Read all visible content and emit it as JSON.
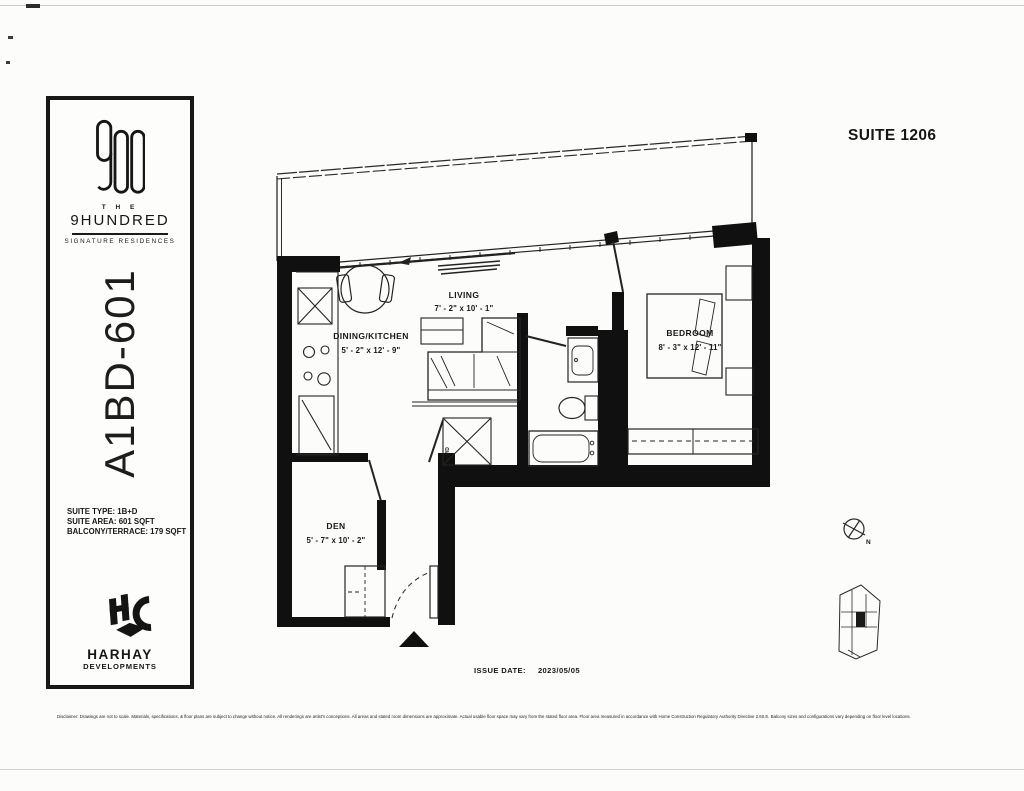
{
  "page": {
    "suite_title": "SUITE 1206",
    "colors": {
      "ink": "#161616",
      "paper": "#fcfcfa"
    }
  },
  "sidebar": {
    "brand": {
      "logo": "900-logo",
      "the": "T H E",
      "name": "9HUNDRED",
      "tagline": "SIGNATURE RESIDENCES"
    },
    "model_code": "A1BD-601",
    "details": [
      "SUITE TYPE: 1B+D",
      "SUITE AREA: 601 SQFT",
      "BALCONY/TERRACE: 179 SQFT"
    ],
    "developer": {
      "logo": "HC",
      "name": "HARHAY",
      "subtitle": "DEVELOPMENTS"
    }
  },
  "floorplan": {
    "rooms": [
      {
        "name": "LIVING",
        "dimensions": "7' - 2\" x 10' - 1\""
      },
      {
        "name": "DINING/KITCHEN",
        "dimensions": "5' - 2\" x 12' - 9\""
      },
      {
        "name": "BEDROOM",
        "dimensions": "8' - 3\" x 12' - 11\""
      },
      {
        "name": "DEN",
        "dimensions": "5' - 7\" x 10' - 2\""
      }
    ],
    "labels": {
      "wd": "W/D",
      "north": "N"
    }
  },
  "footer": {
    "issue_date_label": "ISSUE DATE:",
    "issue_date": "2023/05/05",
    "disclaimer": "Disclaimer: Drawings are not to scale. Materials, specifications, & floor plans are subject to change without notice. All renderings are artist's conceptions. All areas and stated room dimensions are approximate. Actual usable floor space may vary from the stated floor area. Floor area measured in accordance with Home Construction Regulatory Authority Directive 2.60.E. Balcony sizes and configurations vary depending on floor level locations."
  }
}
